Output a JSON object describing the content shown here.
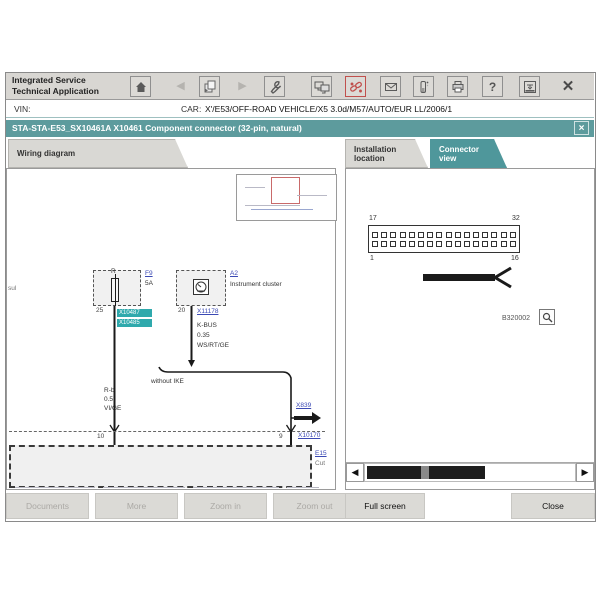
{
  "app": {
    "title_lines": [
      "Integrated Service",
      "Technical Application"
    ],
    "vin_label": "VIN:",
    "car_label": "CAR:",
    "car_value": "X'/E53/OFF-ROAD VEHICLE/X5 3.0d/M57/AUTO/EUR LL/2006/1",
    "doc_title": "STA-STA-E53_SX10461A X10461 Component connector (32-pin, natural)",
    "close_glyph": "×"
  },
  "toolbar": {
    "icons": [
      {
        "name": "home",
        "enabled": true
      },
      {
        "name": "back",
        "enabled": false
      },
      {
        "name": "documents",
        "enabled": true
      },
      {
        "name": "forward",
        "enabled": false
      },
      {
        "name": "tools-wrench",
        "enabled": true
      },
      {
        "name": "workshop-monitors",
        "enabled": true
      },
      {
        "name": "hotline-chain",
        "enabled": true,
        "accent": "#c0504d"
      },
      {
        "name": "mail-envelope",
        "enabled": true
      },
      {
        "name": "measuring-device",
        "enabled": true
      },
      {
        "name": "print",
        "enabled": true
      },
      {
        "name": "help",
        "enabled": true
      },
      {
        "name": "minimize-window",
        "enabled": true
      },
      {
        "name": "close-app",
        "enabled": true
      }
    ],
    "help_glyph": "?"
  },
  "tabs": {
    "wiring": "Wiring diagram",
    "installation": "Installation location",
    "connector": "Connector view",
    "active": "Connector view"
  },
  "wiring_diagram": {
    "edge_label": "sul",
    "fuse": {
      "terminal": "R",
      "ref": "F9",
      "rating": "5A",
      "pin": "25",
      "tags": [
        "X10487",
        "X10485"
      ]
    },
    "cluster": {
      "ref": "A2",
      "name": "Instrument cluster",
      "pin": "20",
      "connector": "X11178",
      "wire_name": "K-BUS",
      "wire_size": "0.35",
      "wire_color": "WS/RT/GE"
    },
    "note": "without IKE",
    "left_wire": {
      "name": "R-b",
      "size": "0.5",
      "color": "VI/GE"
    },
    "branch_link": "X839",
    "pin_left": "10",
    "pin_right": "9",
    "lower_link": "X10170",
    "box_ref": "E15",
    "box_note": "Cut"
  },
  "connector_view": {
    "pin_top_left": "17",
    "pin_top_right": "32",
    "pin_bottom_left": "1",
    "pin_bottom_right": "16",
    "rows": 2,
    "cols": 16,
    "image_ref": "B320002"
  },
  "footer_buttons": [
    {
      "label": "Documents",
      "enabled": false
    },
    {
      "label": "More",
      "enabled": false
    },
    {
      "label": "Zoom in",
      "enabled": false
    },
    {
      "label": "Zoom out",
      "enabled": false
    },
    {
      "label": "Full screen",
      "enabled": true
    },
    {
      "label": "Close",
      "enabled": true
    }
  ],
  "colors": {
    "teal_titlebar": "#5d9b9d",
    "teal_active_tab": "#4f979b",
    "teal_tag": "#2fa9ac",
    "link_blue": "#3b49b4",
    "alert_red": "#c0504d"
  }
}
